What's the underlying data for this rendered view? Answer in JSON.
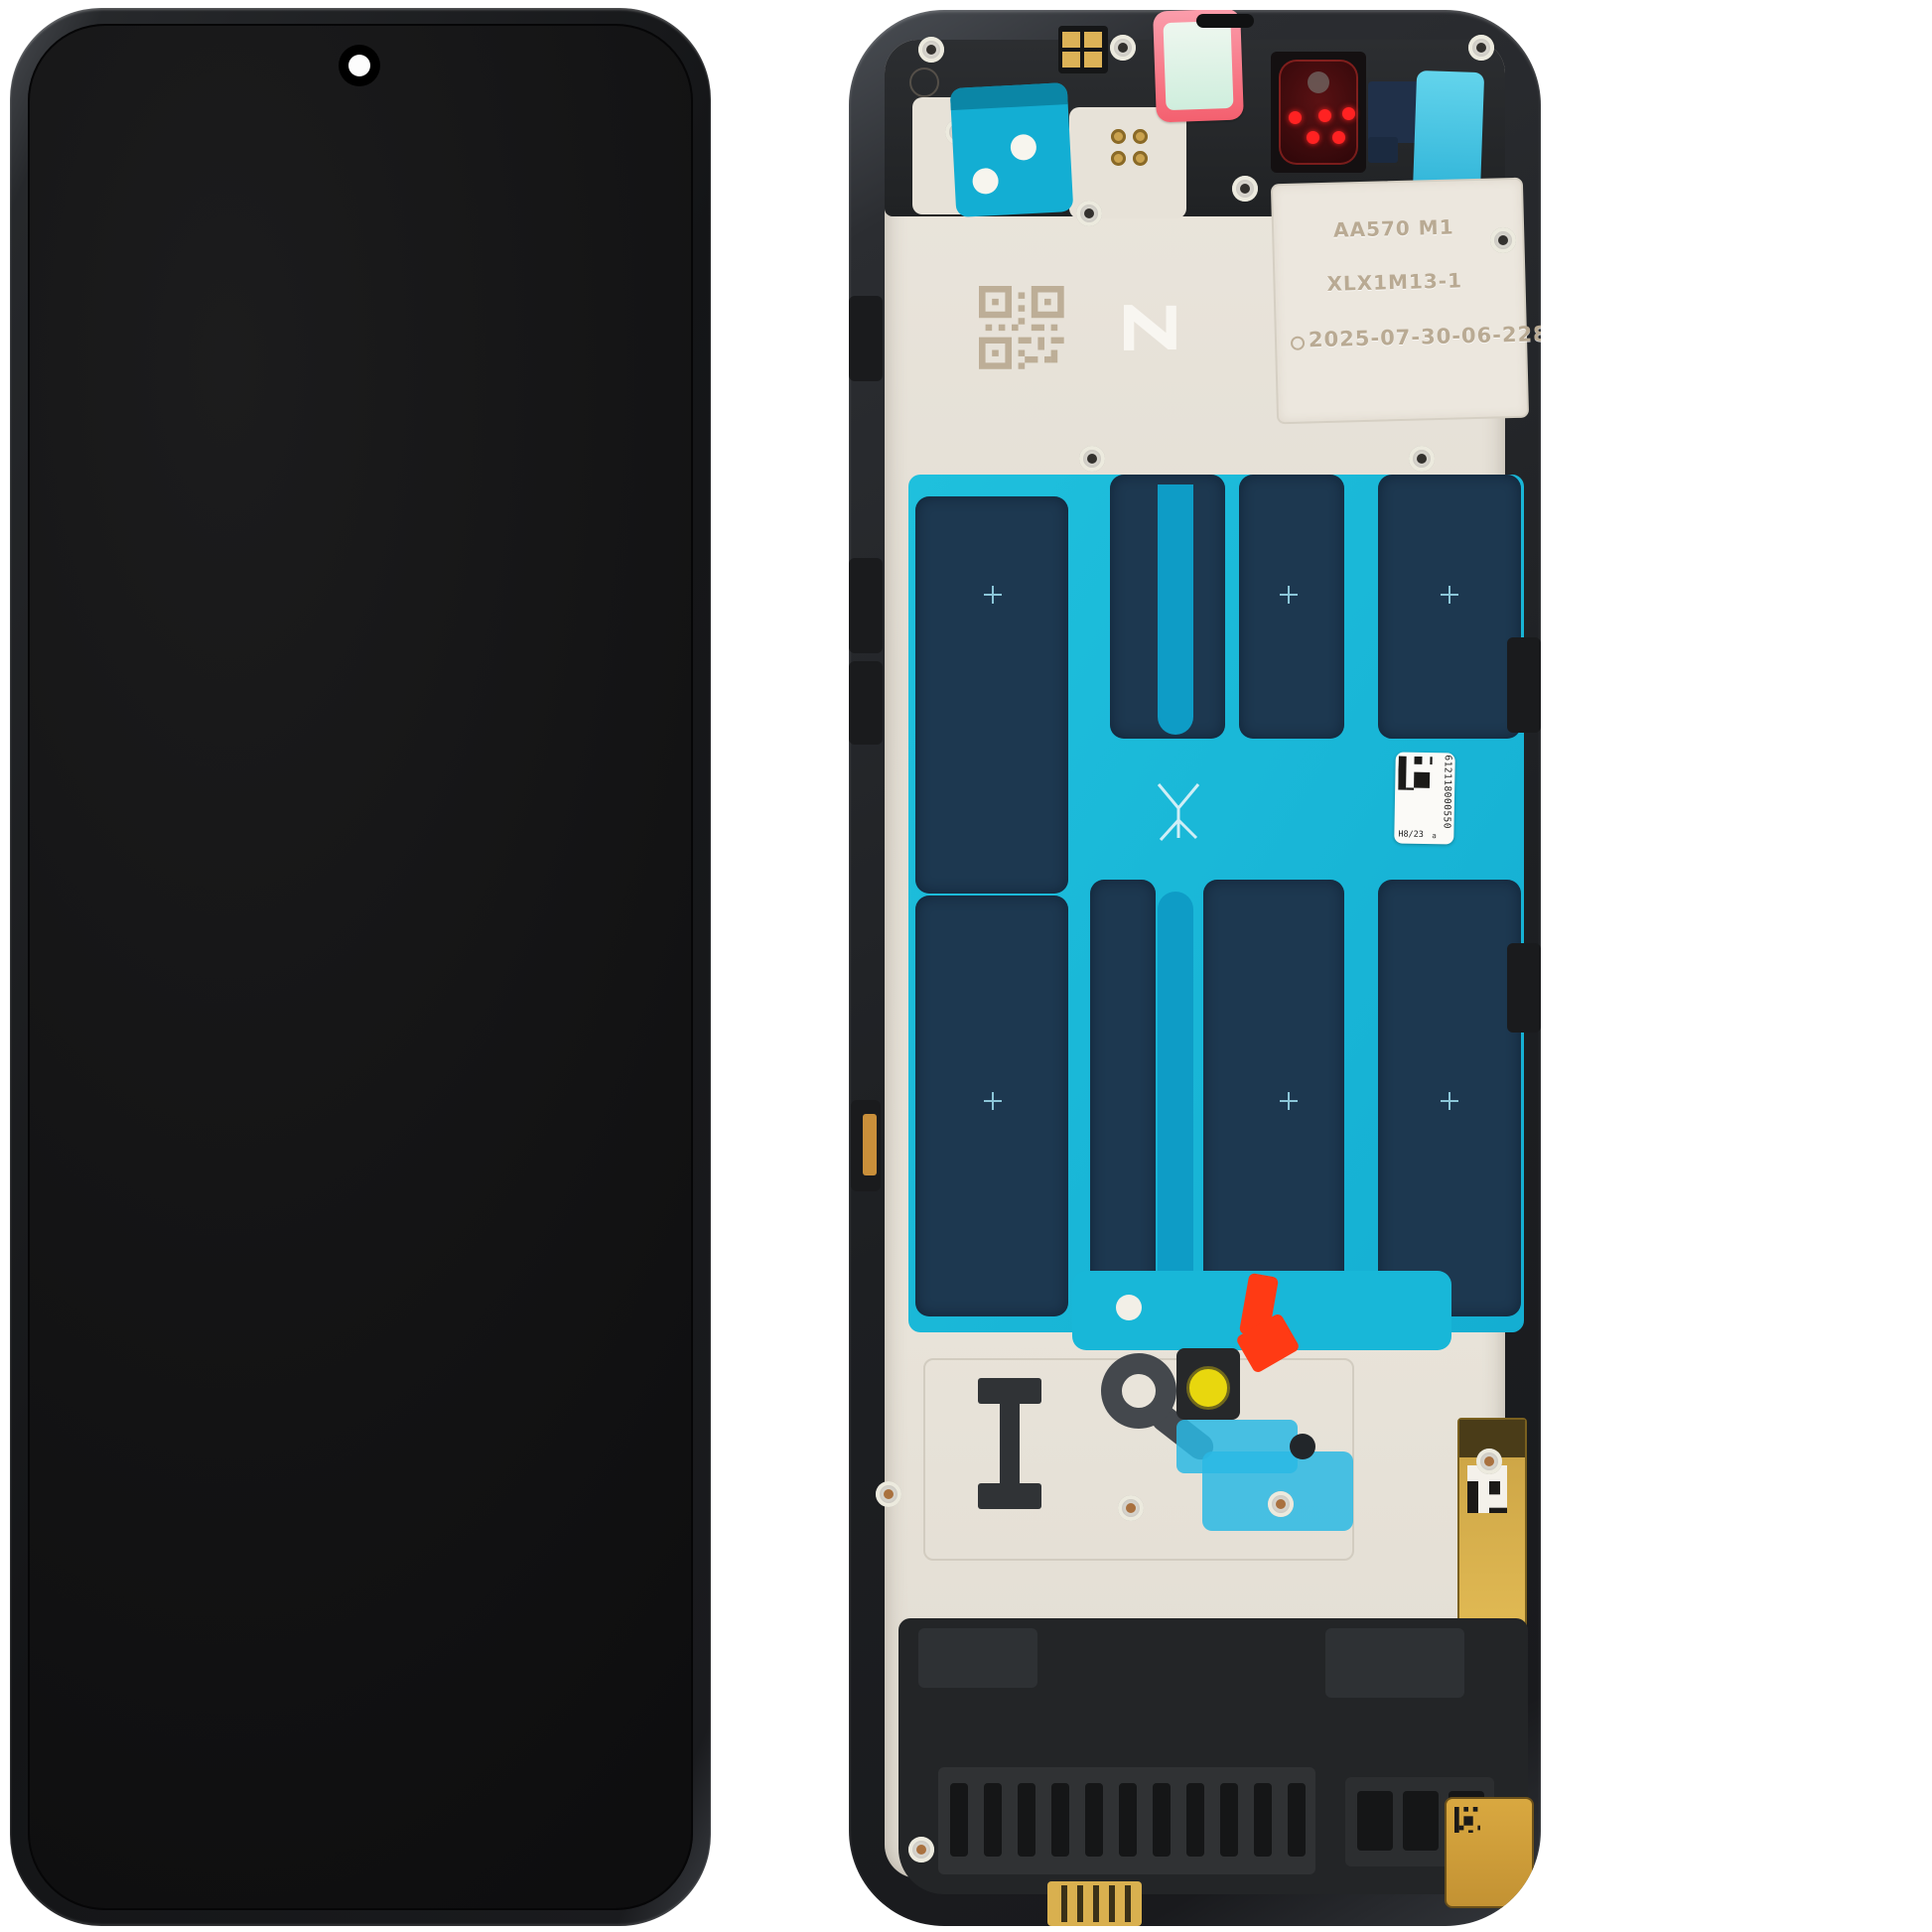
{
  "front_unit": {
    "screen_color": "#141414",
    "frame_color": "#26282b"
  },
  "frame_unit": {
    "etched_plate": {
      "lines": [
        "AA570 M1",
        "XLX1M13-1",
        "2025-07-30-06-228"
      ]
    },
    "z_mark": "Z",
    "comb_label": "24",
    "service_label": {
      "number": "612118000550",
      "batch": "H8/23",
      "rev": "a"
    },
    "colors": {
      "adhesive_cyan": "#18b7d8",
      "adhesive_navy": "#1d3850",
      "plate_cream": "#e7e2d8",
      "camera_dot_red": "#ff2222",
      "warning_tab_orange": "#ff3a14",
      "mic_seal_yellow": "#e8d70e",
      "gold_contact": "#d9b157"
    }
  }
}
